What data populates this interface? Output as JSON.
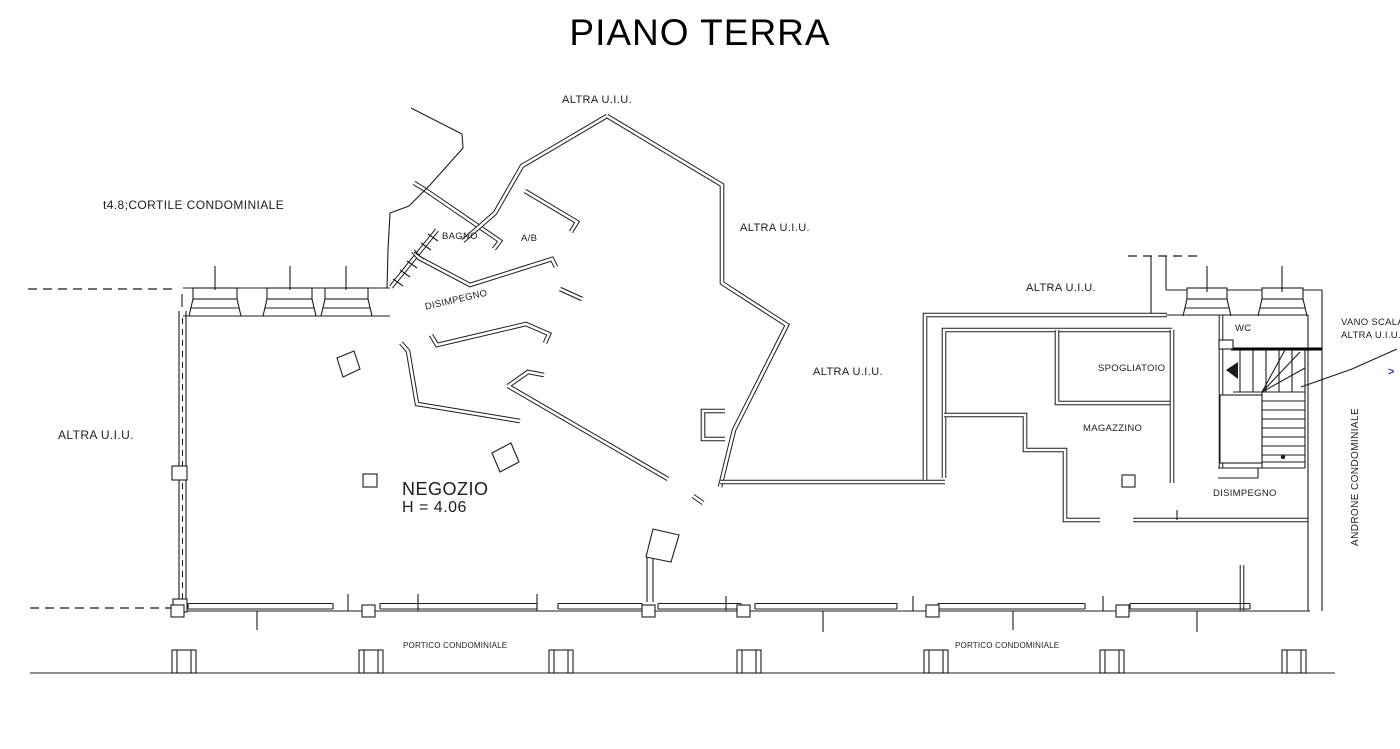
{
  "title": "PIANO TERRA",
  "colors": {
    "line": "#1c1c1c",
    "background": "#ffffff",
    "accent_blue": "#3434cc"
  },
  "rooms": {
    "negozio": {
      "name": "NEGOZIO",
      "height_note": "H = 4.06"
    },
    "bagno": "BAGNO",
    "antibagno": "A/B",
    "disimpegno_center": "DISIMPEGNO",
    "spogliatoio": "SPOGLIATOIO",
    "magazzino": "MAGAZZINO",
    "wc": "WC",
    "disimpegno_right": "DISIMPEGNO"
  },
  "annotations": {
    "altra_uiu": "ALTRA U.I.U.",
    "cortile": "t4.8;CORTILE CONDOMINIALE",
    "androne": "ANDRONE CONDOMINIALE",
    "portico": "PORTICO CONDOMINIALE",
    "edge_mark": ">"
  },
  "callout": {
    "line1": "VANO SCALA",
    "line2": "ALTRA U.I.U."
  }
}
